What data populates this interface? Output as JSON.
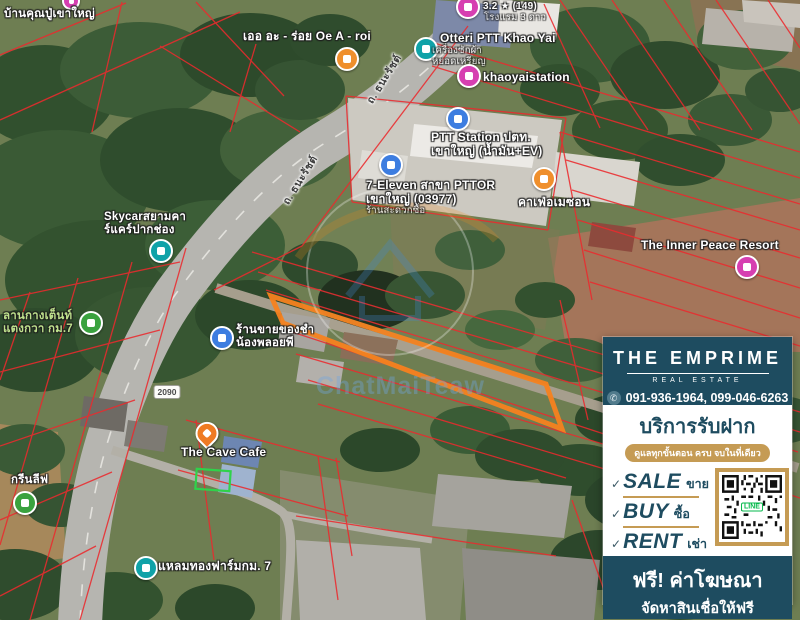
{
  "colors": {
    "parcel_red": "#EA2A2E",
    "highlight_orange": "#F5821F",
    "highlight_green": "#2FD24A",
    "ad_navy": "#1E4C60",
    "ad_gold": "#C59B54"
  },
  "map": {
    "road_label": "ถ. ธนะรัชต์",
    "route_badge": "2090",
    "watermark_text": "ChatMaiTeaw",
    "pois": [
      {
        "name": "baan-khun-pu",
        "label": "บ้านคุณปู่เขาใหญ่"
      },
      {
        "name": "hotel-rating",
        "label": "3.2 ★ (149)",
        "sub": "โรงแรม 3 ดาว"
      },
      {
        "name": "oe-a-roi",
        "label": "เออ อะ - ร่อย Oe A - roi"
      },
      {
        "name": "otteri",
        "label": "Otteri PTT Khao Yai",
        "sub": "เครื่องซักผ้า\nหยอดเหรียญ"
      },
      {
        "name": "khaoyaistation",
        "label": "khaoyaistation"
      },
      {
        "name": "ptt-station",
        "label": "PTT Station ปตท.\nเขาใหญ่ (น้ำมัน+EV)"
      },
      {
        "name": "seven-eleven",
        "label": "7-Eleven สาขา PTTOR\nเขาใหญ่ (03977)",
        "sub": "ร้านสะดวกซื้อ"
      },
      {
        "name": "cafe-amazon",
        "label": "คาเฟ่อเมซอน"
      },
      {
        "name": "inner-peace-resort",
        "label": "The Inner Peace Resort"
      },
      {
        "name": "skycar",
        "label": "Skycarสยามคา\nร์แคร์ปากช่อง"
      },
      {
        "name": "camping-km7",
        "label": "ลานกางเต็นท์\nแตงกวา กม.7"
      },
      {
        "name": "grocery",
        "label": "ร้านขายของชำ\nน้องพลอยพี"
      },
      {
        "name": "cave-cafe",
        "label": "The Cave Cafe"
      },
      {
        "name": "green-leaf",
        "label": "กรีนลีฟ"
      },
      {
        "name": "laemthong-farm",
        "label": "แหลมทองฟาร์มกม. 7"
      }
    ]
  },
  "ad": {
    "brand": "THE EMPRIME",
    "brand_sub": "REAL ESTATE",
    "phone_icon": "✆",
    "phones": "091-936-1964, 099-046-6263",
    "service_title": "บริการรับฝาก",
    "service_sub": "ดูแลทุกขั้นตอน ครบ จบในที่เดียว",
    "check": "✓",
    "items": [
      {
        "en": "SALE",
        "th": "ขาย"
      },
      {
        "en": "BUY",
        "th": "ซื้อ"
      },
      {
        "en": "RENT",
        "th": "เช่า"
      }
    ],
    "qr_label": "LINE",
    "footer_line1": "ฟรี! ค่าโฆษณา",
    "footer_line2": "จัดหาสินเชื่อให้ฟรี"
  }
}
